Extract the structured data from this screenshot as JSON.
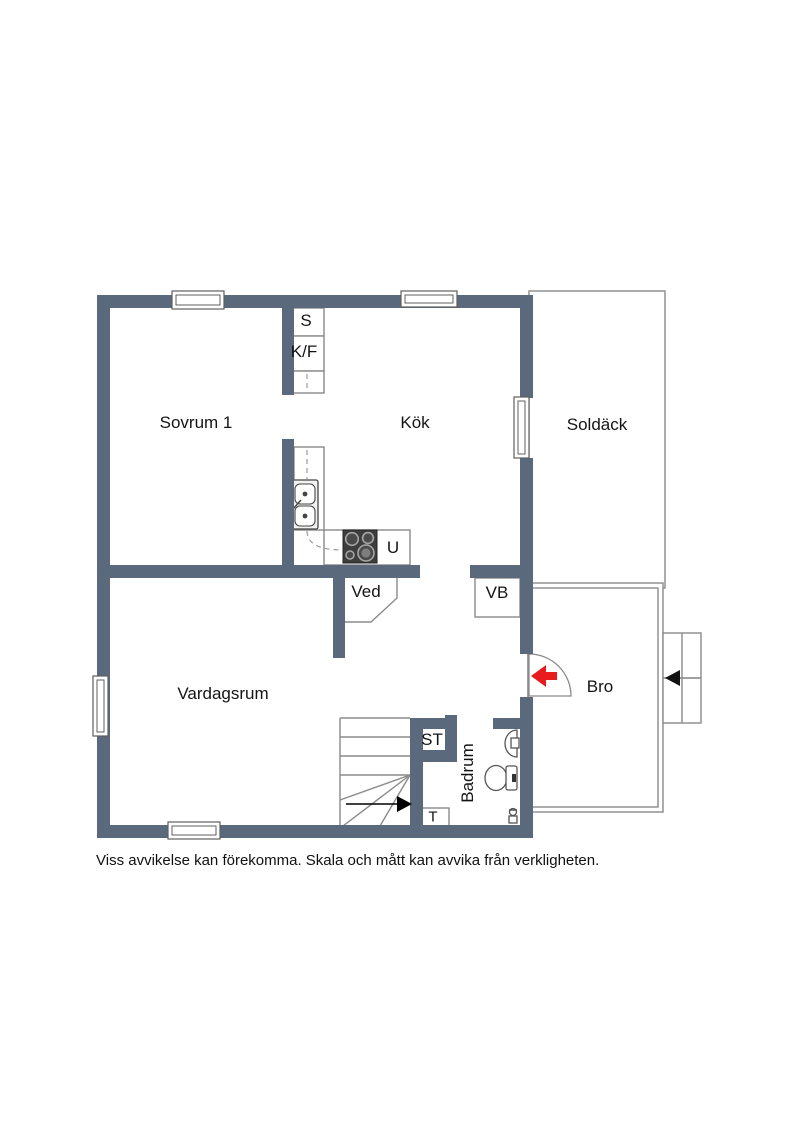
{
  "floorplan": {
    "rooms": {
      "sovrum1": "Sovrum 1",
      "kok": "Kök",
      "soldack": "Soldäck",
      "vardagsrum": "Vardagsrum",
      "bro": "Bro",
      "badrum": "Badrum",
      "ved": "Ved"
    },
    "fixtures": {
      "s": "S",
      "kf": "K/F",
      "u": "U",
      "vb": "VB",
      "st": "ST",
      "t": "T"
    },
    "icons": {
      "entry_arrow": "left-arrow-entrance-marker",
      "steps_arrow": "left-arrow-steps-marker",
      "stairs_arrow": "right-arrow-stairs-direction"
    },
    "colors": {
      "wall": "#5a6a7c",
      "outline": "#8a8a8a",
      "entry_arrow": "#e81c1c",
      "fixture_dark": "#3d3d3d"
    }
  },
  "footer": {
    "disclaimer": "Viss avvikelse kan förekomma. Skala och mått kan avvika från verkligheten."
  }
}
